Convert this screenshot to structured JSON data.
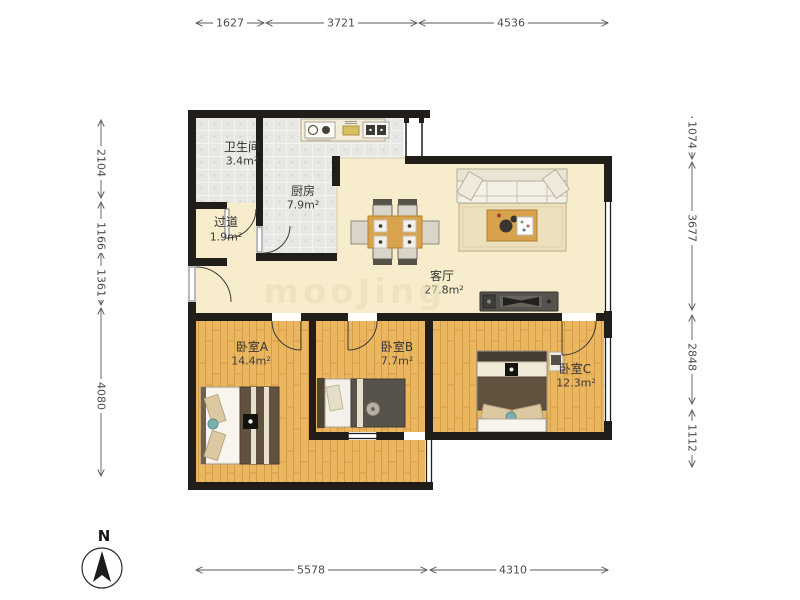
{
  "plan": {
    "rooms": {
      "bathroom": {
        "name": "卫生间",
        "area": "3.4m²"
      },
      "kitchen": {
        "name": "厨房",
        "area": "7.9m²"
      },
      "hallway": {
        "name": "过道",
        "area": "1.9m²"
      },
      "living": {
        "name": "客厅",
        "area": "27.8m²"
      },
      "bedroomA": {
        "name": "卧室A",
        "area": "14.4m²"
      },
      "bedroomB": {
        "name": "卧室B",
        "area": "7.7m²"
      },
      "bedroomC": {
        "name": "卧室C",
        "area": "12.3m²"
      }
    },
    "dimensions": {
      "top": [
        "1627",
        "3721",
        "4536"
      ],
      "bottom": [
        "5578",
        "4310"
      ],
      "left": [
        "2104",
        "1166",
        "1361",
        "4080"
      ],
      "right": [
        "1074",
        "3677",
        "2848",
        "1112"
      ]
    },
    "compass": {
      "label": "N"
    },
    "watermark": {
      "text": "mooJing"
    },
    "colors": {
      "wall": "#211e19",
      "wood_floor": "#ebb660",
      "tile_floor": "#e7e7e3",
      "main_floor": "#f7edcc",
      "dimension_text": "#4c4c4c"
    }
  }
}
